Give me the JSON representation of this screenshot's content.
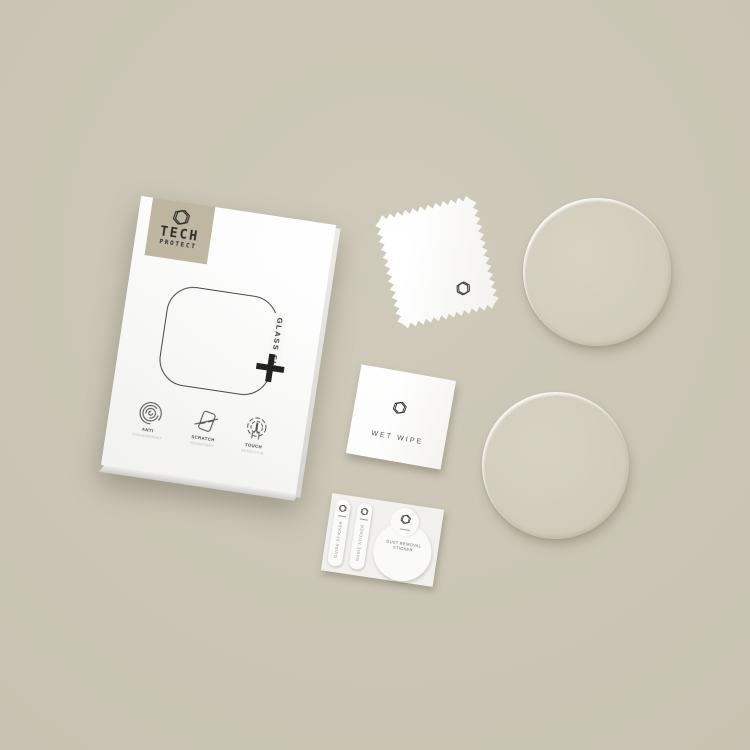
{
  "colors": {
    "background": "#cbc6b4",
    "logo_square": "#bdb49e",
    "box_face": "#ffffff",
    "ink": "#1f1f1f",
    "glass_tint": "#d2cdbc"
  },
  "box": {
    "brand_line1": "TECH",
    "brand_line2": "PROTECT",
    "product_label": "GLASS FIT",
    "plus_mark": "+",
    "features": [
      {
        "title": "ANTI",
        "subtitle": "FINGERPRINT"
      },
      {
        "title": "SCRATCH",
        "subtitle": "RESISTANT"
      },
      {
        "title": "TOUCH",
        "subtitle": "SENSITIVE"
      }
    ]
  },
  "wet_wipe": {
    "label": "WET WIPE"
  },
  "sticker_sheet": {
    "guide_stickers": [
      "GUIDE STICKER",
      "GUIDE STICKER"
    ],
    "dust_removal": {
      "line1": "DUST REMOVAL",
      "line2": "STICKER"
    }
  },
  "icons": [
    "hexagon-logo-icon",
    "fingerprint-icon",
    "scratch-resistant-icon",
    "touch-sensitive-icon"
  ]
}
